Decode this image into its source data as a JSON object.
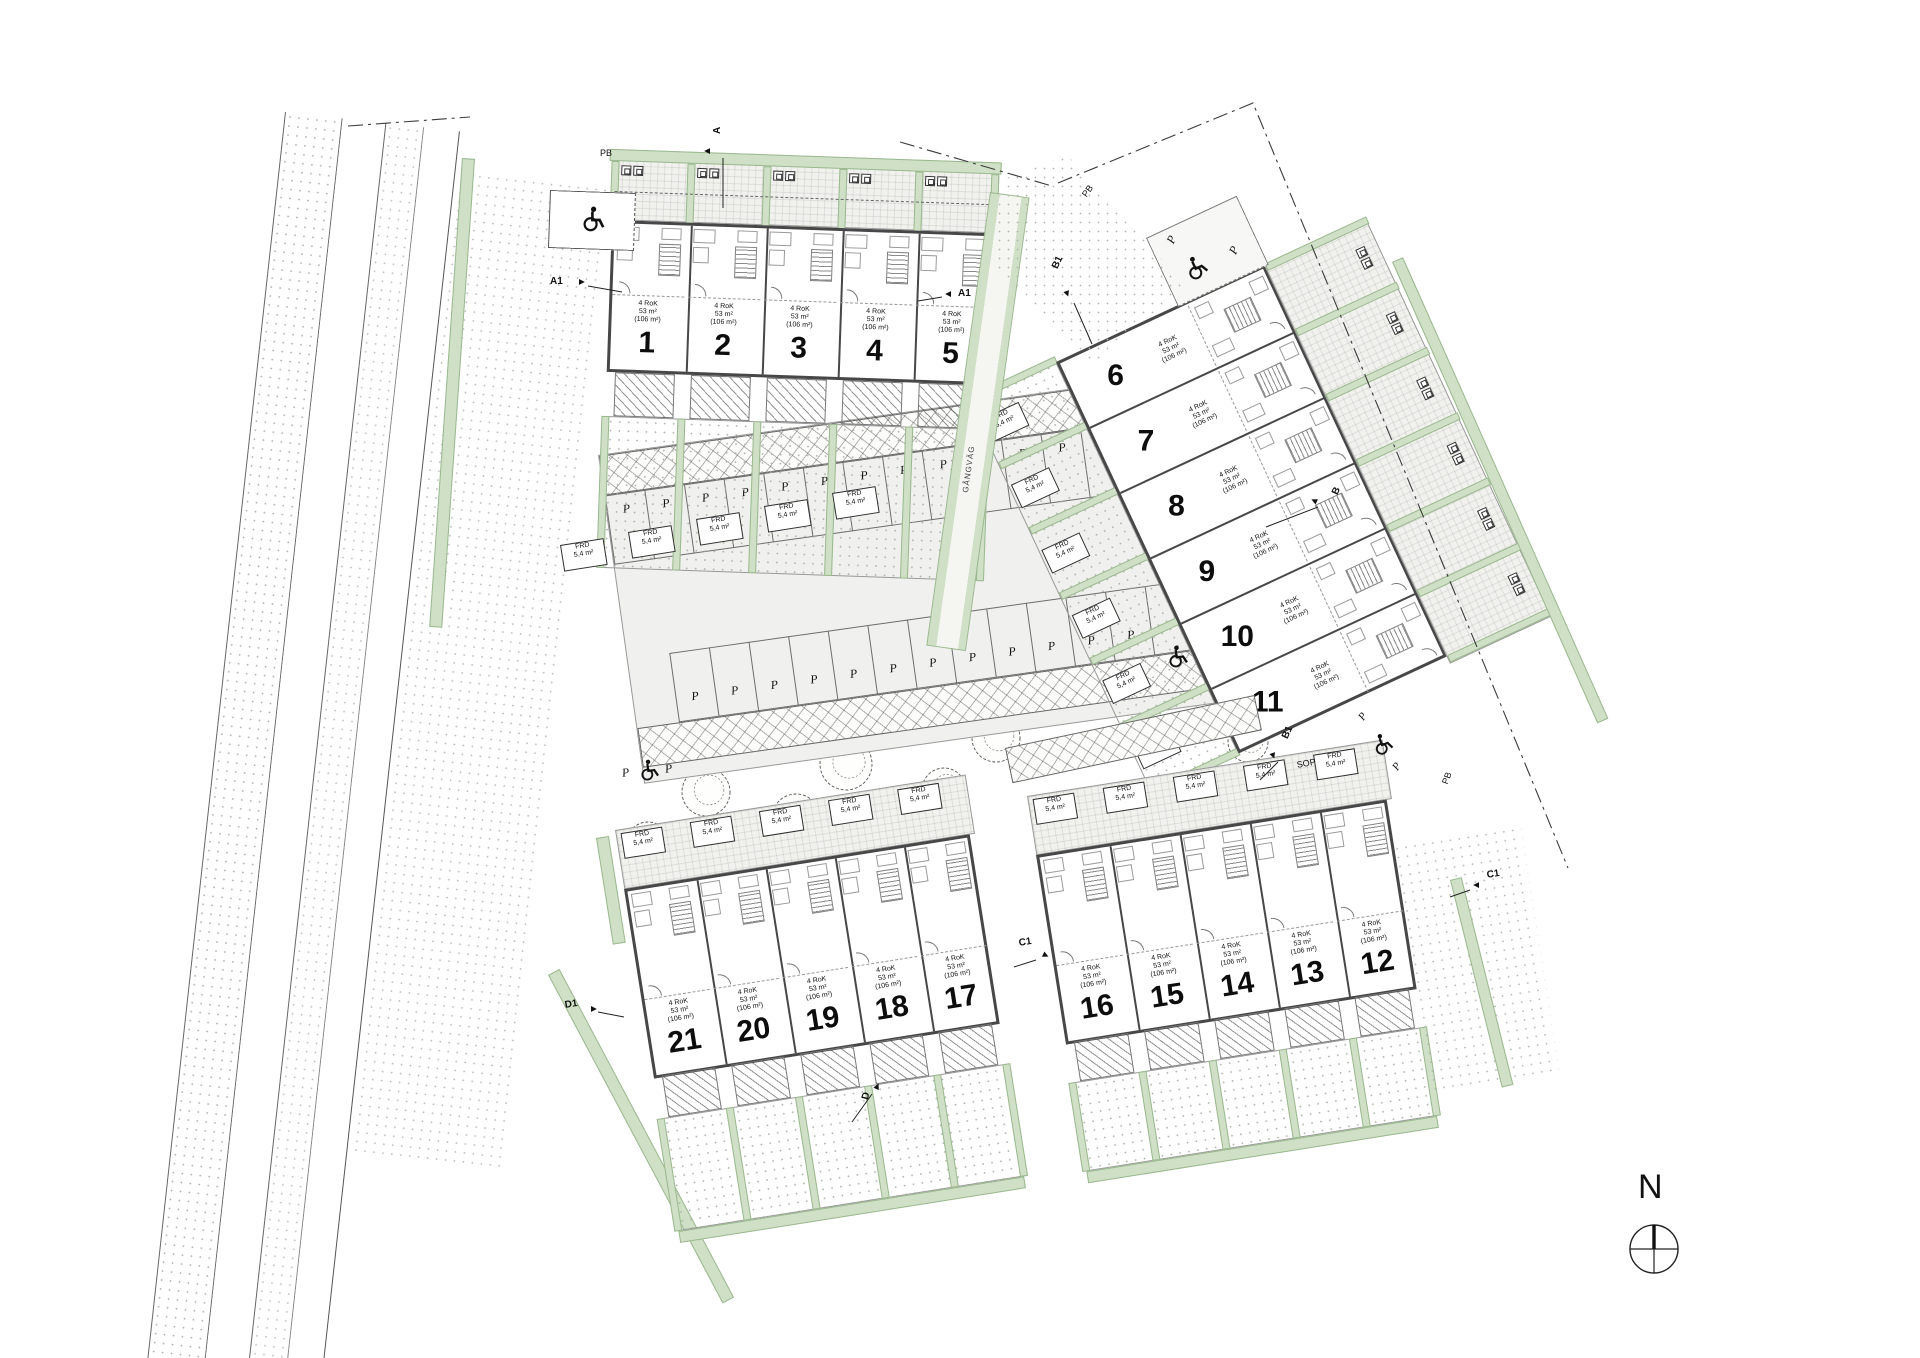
{
  "site": {
    "north_label": "N",
    "walkway_label": "GÅNGVÄG",
    "boundary_label": "PB",
    "waste_room_label": "SOP",
    "parking_space_label": "P",
    "storage": {
      "name": "FRD",
      "area": "5,4 m²"
    },
    "unit_info": {
      "type": "4 RoK",
      "area": "53 m²",
      "total_area": "(106 m²)"
    }
  },
  "blocks": [
    {
      "id": "A",
      "units": [
        "1",
        "2",
        "3",
        "4",
        "5"
      ]
    },
    {
      "id": "B",
      "units": [
        "6",
        "7",
        "8",
        "9",
        "10",
        "11"
      ]
    },
    {
      "id": "C",
      "units": [
        "16",
        "15",
        "14",
        "13",
        "12"
      ]
    },
    {
      "id": "D",
      "units": [
        "21",
        "20",
        "19",
        "18",
        "17"
      ]
    }
  ],
  "section_markers": [
    {
      "label": "A"
    },
    {
      "label": "A1"
    },
    {
      "label": "A1"
    },
    {
      "label": "B1"
    },
    {
      "label": "B"
    },
    {
      "label": "B1"
    },
    {
      "label": "C1"
    },
    {
      "label": "C1"
    },
    {
      "label": "D1"
    },
    {
      "label": "D"
    }
  ],
  "colors": {
    "hedge": "#cfe0c6",
    "hedge_border": "#9bb88f",
    "wall": "#474747",
    "paving": "#f0f0ee",
    "ink": "#1a1a1a"
  }
}
